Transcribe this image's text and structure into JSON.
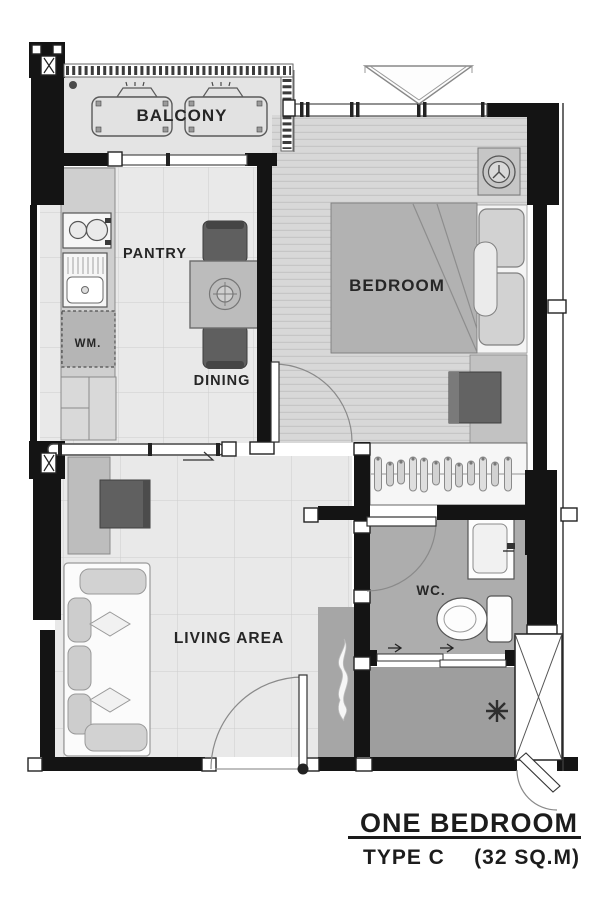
{
  "plan_title": {
    "name": "ONE BEDROOM",
    "type": "TYPE C",
    "area": "(32 SQ.M)"
  },
  "rooms": {
    "balcony": "BALCONY",
    "pantry": "PANTRY",
    "dining": "DINING",
    "bedroom": "BEDROOM",
    "living_area": "LIVING AREA",
    "wc": "WC.",
    "washing_machine": "WM."
  },
  "colors": {
    "wall": "#141414",
    "floor_tile": "#e9e9e9",
    "floor_tile_line": "#cdcdcd",
    "floor_plank": "#d8d8d8",
    "floor_plank_line": "#c6c6c6",
    "balcony_floor": "#e4e4e4",
    "wc_floor": "#adadad",
    "foyer_floor": "#9e9e9e",
    "entry_strip_floor": "#a6a6a6",
    "bed_fill": "#b2b2b2",
    "furniture_dark": "#5f5f5f",
    "furniture_mid": "#bdbdbd",
    "fixture_white": "#fbfbfb",
    "text": "#262626"
  }
}
